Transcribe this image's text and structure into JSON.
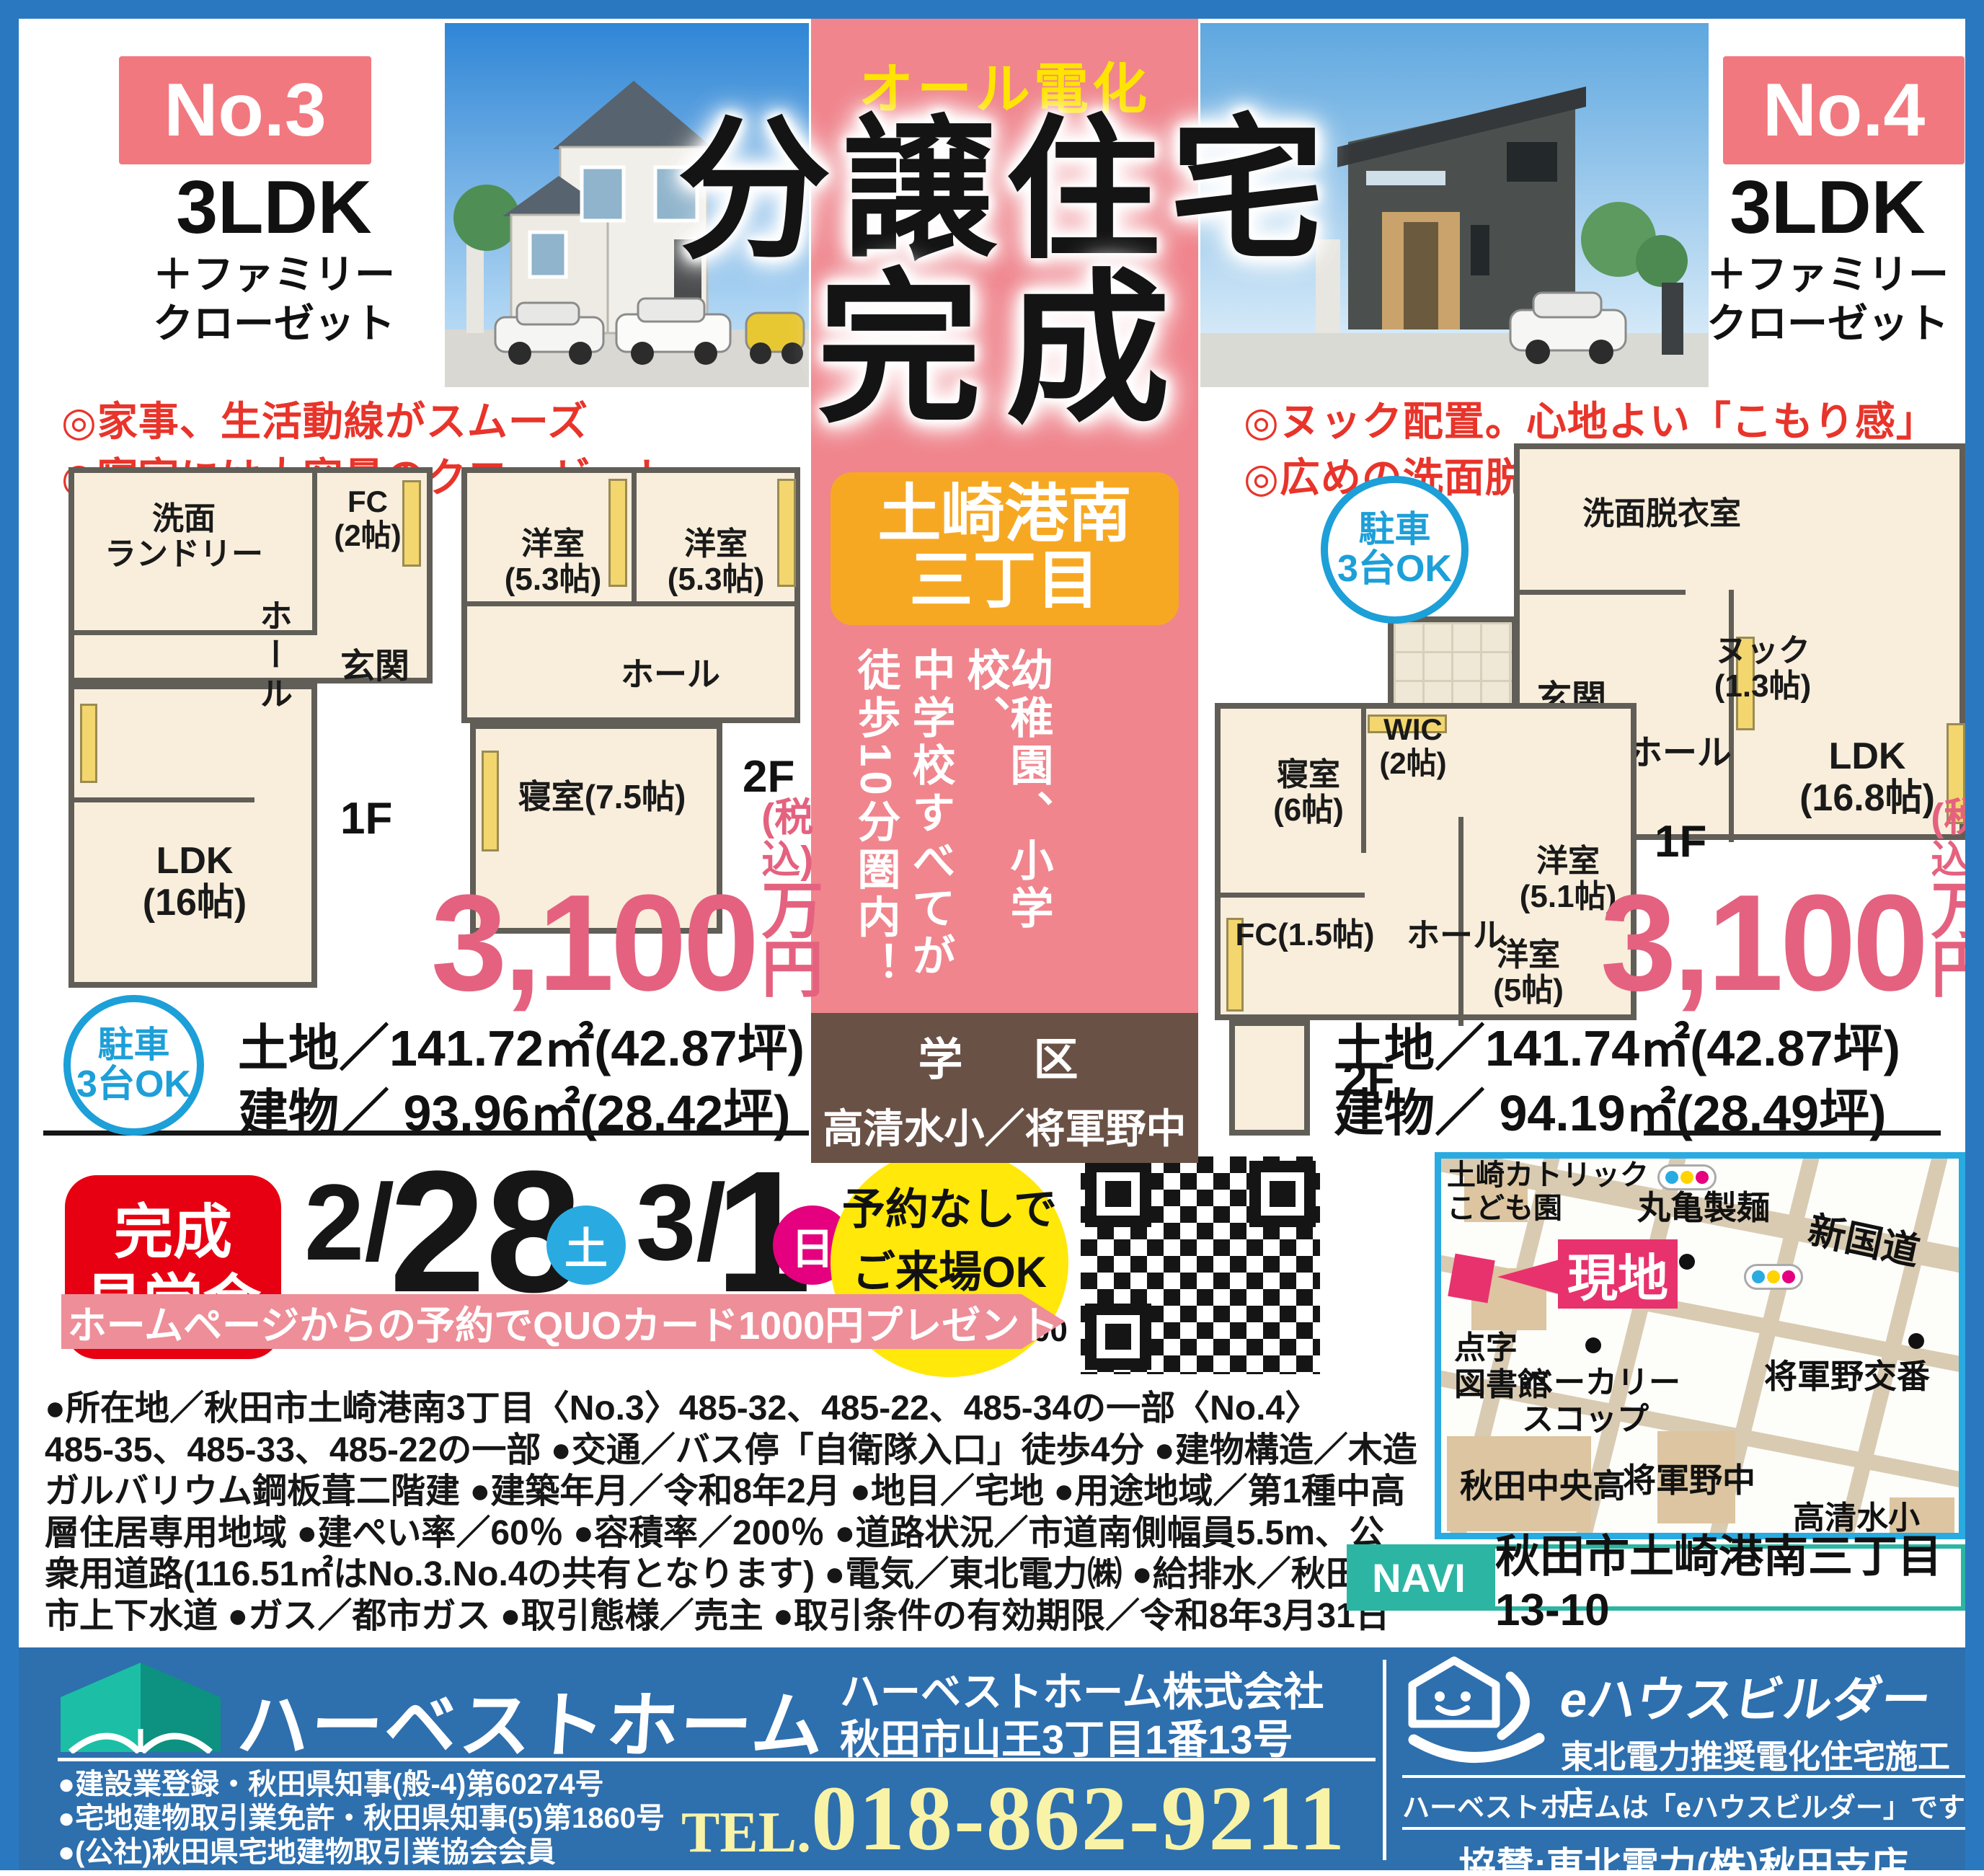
{
  "colors": {
    "frame": "#2a79c0",
    "pink_column": "#f0858d",
    "accent_red": "#e8342a",
    "price_pink": "#e4627f",
    "orange": "#f7a823",
    "brown": "#6a5146",
    "teal": "#2cb5a3",
    "footer_blue": "#2e6fae",
    "yellow": "#ffe400",
    "sat_blue": "#29abe2",
    "sun_pink": "#e4007f",
    "site_pink": "#e8326d",
    "event_red": "#e60012"
  },
  "units": {
    "no3": {
      "badge": "No.3",
      "type": "3LDK",
      "type_sub1": "＋ファミリー",
      "type_sub2": "クローゼット",
      "feature1": "◎家事、生活動線がスムーズ",
      "feature2": "◎寝室には大容量のクローゼット",
      "f1_label": "1F",
      "f2_label": "2F",
      "f1_rooms": [
        "洗面\nランドリー",
        "FC\n(2帖)",
        "玄関",
        "ホール",
        "LDK\n(16帖)"
      ],
      "f2_rooms": [
        "洋室\n(5.3帖)",
        "洋室\n(5.3帖)",
        "ホール",
        "寝室(7.5帖)"
      ],
      "price": "3,100",
      "price_tax": "(税込)",
      "price_unit": "万円",
      "parking_line1": "駐車",
      "parking_line2": "3台OK",
      "land": "土地／141.72㎡(42.87坪)",
      "building": "建物／ 93.96㎡(28.42坪)"
    },
    "no4": {
      "badge": "No.4",
      "type": "3LDK",
      "type_sub1": "＋ファミリー",
      "type_sub2": "クローゼット",
      "feature1": "◎ヌック配置。心地よい「こもり感」",
      "feature2": "◎広めの洗面脱衣室、各所に収納",
      "f1_label": "1F",
      "f2_label": "2F",
      "f1_rooms": [
        "洗面脱衣室",
        "ヌック\n(1.3帖)",
        "玄関",
        "ホール",
        "LDK\n(16.8帖)"
      ],
      "f2_rooms": [
        "寝室\n(6帖)",
        "WIC\n(2帖)",
        "FC(1.5帖)",
        "ホール",
        "洋室\n(5.1帖)",
        "洋室\n(5帖)"
      ],
      "price": "3,100",
      "price_tax": "(税込)",
      "price_unit": "万円",
      "parking_line1": "駐車",
      "parking_line2": "3台OK",
      "land": "土地／141.74㎡(42.87坪)",
      "building": "建物／ 94.19㎡(28.49坪)"
    }
  },
  "center": {
    "all_electric": "オール電化",
    "title1": "分譲住宅",
    "title2": "完成",
    "location1": "土崎港南",
    "location2": "三丁目",
    "vertical": [
      "幼稚園、小学校、",
      "中学校すべてが",
      "徒歩10分圏内！"
    ],
    "district_label": "学　区",
    "district": "高清水小／将軍野中"
  },
  "event": {
    "title1": "完成",
    "title2": "見学会",
    "d1_prefix": "2/",
    "d1_day": "28",
    "d1_dow": "土",
    "d2_prefix": "3/",
    "d2_day": "1",
    "d2_dow": "日",
    "note1": "予約なしで",
    "note2": "ご来場OK",
    "note3": "10：00～17：00",
    "banner": "ホームページからの予約でQUOカード1000円プレゼント"
  },
  "details": {
    "lines": [
      "●所在地／秋田市土崎港南3丁目〈No.3〉485-32、485-22、485-34の一部〈No.4〉",
      "485-35、485-33、485-22の一部 ●交通／バス停「自衛隊入口」徒歩4分 ●建物構造／木造",
      "ガルバリウム鋼板葺二階建 ●建築年月／令和8年2月 ●地目／宅地 ●用途地域／第1種中高",
      "層住居専用地域 ●建ぺい率／60％ ●容積率／200％ ●道路状況／市道南側幅員5.5m、公",
      "衆用道路(116.51㎡はNo.3.No.4の共有となります) ●電気／東北電力㈱ ●給排水／秋田",
      "市上下水道 ●ガス／都市ガス ●取引態様／売主 ●取引条件の有効期限／令和8年3月31日"
    ]
  },
  "map": {
    "labels": [
      "土崎カトリック\nこども園",
      "丸亀製麺",
      "新国道",
      "点字\n図書館",
      "ベーカリー\nスコップ",
      "将軍野交番",
      "秋田中央高",
      "将軍野中",
      "高清水小"
    ],
    "site": "現地",
    "navi_label": "NAVI",
    "navi_address": "秋田市土崎港南三丁目13-10"
  },
  "footer": {
    "brand": "ハーベストホーム",
    "company": "ハーベストホーム株式会社",
    "address": "秋田市山王3丁目1番13号",
    "regs": [
      "●建設業登録・秋田県知事(般-4)第60274号",
      "●宅地建物取引業免許・秋田県知事(5)第1860号",
      "●(公社)秋田県宅地建物取引業協会会員"
    ],
    "tel_label": "TEL.",
    "tel": "018-862-9211",
    "ehouse_name": "eハウスビルダー",
    "ehouse_sub": "東北電力推奨電化住宅施工店",
    "ehouse_phrase": "ハーベストホームは「eハウスビルダー」です",
    "sponsor": "協賛:東北電力(株)秋田支店"
  }
}
